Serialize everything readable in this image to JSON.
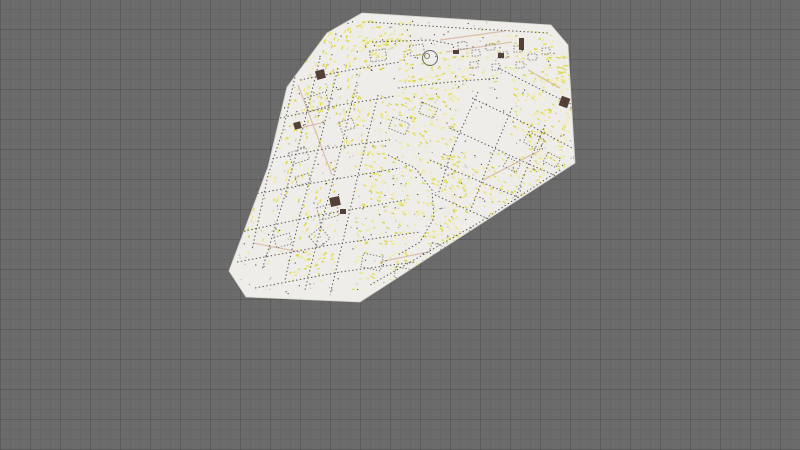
{
  "canvas": {
    "width": 800,
    "height": 450,
    "background": "#6b6b6b",
    "grid_minor_step": 10,
    "grid_major_step": 30
  },
  "map": {
    "fill": "#efedea",
    "edge_stroke": "#d6d3ce",
    "outline": [
      [
        362,
        13
      ],
      [
        551,
        25
      ],
      [
        568,
        45
      ],
      [
        575,
        163
      ],
      [
        360,
        302
      ],
      [
        246,
        297
      ],
      [
        229,
        271
      ],
      [
        268,
        167
      ],
      [
        287,
        87
      ],
      [
        327,
        33
      ]
    ],
    "colors": {
      "street": "#565656",
      "building": "#787672",
      "accent": "#d9bfae",
      "dark_mark": "#554038",
      "landmark": "#6b6b6b",
      "noise_dark": "#454545",
      "noise_light": "#c9c6c1",
      "noise_mid": "#8f8d89"
    },
    "label_colors": [
      "#e3df5e",
      "#eae781",
      "#f0eda6",
      "#d9d544",
      "#eeebc2"
    ],
    "streets": [
      [
        [
          300,
          55
        ],
        [
          283,
          130
        ],
        [
          268,
          175
        ],
        [
          252,
          250
        ]
      ],
      [
        [
          320,
          58
        ],
        [
          300,
          140
        ],
        [
          285,
          195
        ],
        [
          262,
          270
        ]
      ],
      [
        [
          338,
          68
        ],
        [
          318,
          150
        ],
        [
          300,
          215
        ],
        [
          285,
          280
        ]
      ],
      [
        [
          357,
          82
        ],
        [
          338,
          160
        ],
        [
          320,
          230
        ],
        [
          305,
          290
        ]
      ],
      [
        [
          378,
          95
        ],
        [
          358,
          175
        ],
        [
          342,
          245
        ],
        [
          330,
          295
        ]
      ],
      [
        [
          265,
          160
        ],
        [
          330,
          148
        ],
        [
          390,
          140
        ]
      ],
      [
        [
          250,
          195
        ],
        [
          330,
          180
        ],
        [
          400,
          168
        ]
      ],
      [
        [
          240,
          232
        ],
        [
          320,
          215
        ],
        [
          405,
          200
        ]
      ],
      [
        [
          237,
          262
        ],
        [
          330,
          245
        ],
        [
          420,
          232
        ]
      ],
      [
        [
          255,
          288
        ],
        [
          340,
          272
        ],
        [
          415,
          262
        ]
      ],
      [
        [
          280,
          118
        ],
        [
          340,
          105
        ],
        [
          395,
          96
        ]
      ],
      [
        [
          300,
          80
        ],
        [
          350,
          70
        ],
        [
          400,
          62
        ]
      ],
      [
        [
          430,
          160
        ],
        [
          500,
          190
        ],
        [
          550,
          210
        ]
      ],
      [
        [
          450,
          128
        ],
        [
          520,
          160
        ],
        [
          565,
          180
        ]
      ],
      [
        [
          472,
          98
        ],
        [
          535,
          128
        ],
        [
          572,
          148
        ]
      ],
      [
        [
          498,
          68
        ],
        [
          552,
          95
        ],
        [
          573,
          105
        ]
      ],
      [
        [
          435,
          195
        ],
        [
          495,
          222
        ],
        [
          530,
          238
        ]
      ],
      [
        [
          478,
          92
        ],
        [
          452,
          150
        ],
        [
          438,
          195
        ]
      ],
      [
        [
          512,
          108
        ],
        [
          488,
          165
        ],
        [
          470,
          212
        ]
      ],
      [
        [
          545,
          125
        ],
        [
          522,
          180
        ],
        [
          505,
          228
        ]
      ],
      [
        [
          368,
          22
        ],
        [
          460,
          28
        ],
        [
          548,
          33
        ]
      ],
      [
        [
          372,
          42
        ],
        [
          430,
          40
        ],
        [
          455,
          45
        ]
      ],
      [
        [
          398,
          88
        ],
        [
          450,
          82
        ],
        [
          500,
          78
        ]
      ],
      [
        [
          388,
          155
        ],
        [
          415,
          168
        ],
        [
          432,
          190
        ],
        [
          434,
          218
        ],
        [
          420,
          242
        ],
        [
          398,
          255
        ]
      ],
      [
        [
          560,
          170
        ],
        [
          480,
          222
        ],
        [
          400,
          268
        ],
        [
          370,
          285
        ]
      ]
    ],
    "accent_lines": [
      [
        [
          440,
          40
        ],
        [
          505,
          31
        ]
      ],
      [
        [
          446,
          52
        ],
        [
          512,
          42
        ]
      ],
      [
        [
          298,
          85
        ],
        [
          332,
          175
        ]
      ],
      [
        [
          253,
          243
        ],
        [
          300,
          252
        ]
      ],
      [
        [
          483,
          180
        ],
        [
          539,
          151
        ]
      ],
      [
        [
          380,
          262
        ],
        [
          428,
          252
        ]
      ],
      [
        [
          528,
          70
        ],
        [
          560,
          88
        ]
      ],
      [
        [
          300,
          128
        ],
        [
          325,
          122
        ]
      ]
    ],
    "buildings": [
      {
        "x": 306,
        "y": 95,
        "w": 22,
        "h": 14,
        "a": -18
      },
      {
        "x": 290,
        "y": 150,
        "w": 18,
        "h": 12,
        "a": -18
      },
      {
        "x": 318,
        "y": 205,
        "w": 20,
        "h": 13,
        "a": -15
      },
      {
        "x": 275,
        "y": 235,
        "w": 16,
        "h": 11,
        "a": -15
      },
      {
        "x": 340,
        "y": 120,
        "w": 14,
        "h": 10,
        "a": -18
      },
      {
        "x": 296,
        "y": 175,
        "w": 14,
        "h": 9,
        "a": -17
      },
      {
        "x": 370,
        "y": 50,
        "w": 16,
        "h": 11,
        "a": -8
      },
      {
        "x": 410,
        "y": 45,
        "w": 14,
        "h": 10,
        "a": -8
      },
      {
        "x": 458,
        "y": 42,
        "w": 9,
        "h": 7,
        "a": -5
      },
      {
        "x": 472,
        "y": 50,
        "w": 8,
        "h": 6,
        "a": -5
      },
      {
        "x": 486,
        "y": 44,
        "w": 9,
        "h": 6,
        "a": -5
      },
      {
        "x": 500,
        "y": 52,
        "w": 8,
        "h": 6,
        "a": -5
      },
      {
        "x": 514,
        "y": 46,
        "w": 8,
        "h": 6,
        "a": -3
      },
      {
        "x": 528,
        "y": 54,
        "w": 9,
        "h": 6,
        "a": -3
      },
      {
        "x": 542,
        "y": 48,
        "w": 8,
        "h": 6,
        "a": -3
      },
      {
        "x": 470,
        "y": 62,
        "w": 8,
        "h": 6,
        "a": -5
      },
      {
        "x": 492,
        "y": 64,
        "w": 8,
        "h": 6,
        "a": -5
      },
      {
        "x": 516,
        "y": 62,
        "w": 8,
        "h": 6,
        "a": -3
      },
      {
        "x": 525,
        "y": 135,
        "w": 18,
        "h": 12,
        "a": 28
      },
      {
        "x": 545,
        "y": 155,
        "w": 14,
        "h": 10,
        "a": 28
      },
      {
        "x": 505,
        "y": 160,
        "w": 14,
        "h": 10,
        "a": 28
      },
      {
        "x": 362,
        "y": 255,
        "w": 20,
        "h": 14,
        "a": 12
      },
      {
        "x": 395,
        "y": 268,
        "w": 16,
        "h": 11,
        "a": 12
      },
      {
        "x": 430,
        "y": 245,
        "w": 16,
        "h": 11,
        "a": 20
      },
      {
        "x": 468,
        "y": 230,
        "w": 16,
        "h": 11,
        "a": 22
      },
      {
        "x": 500,
        "y": 215,
        "w": 14,
        "h": 10,
        "a": 25
      },
      {
        "x": 390,
        "y": 120,
        "w": 18,
        "h": 12,
        "a": 22
      },
      {
        "x": 420,
        "y": 105,
        "w": 16,
        "h": 11,
        "a": 22
      },
      {
        "x": 312,
        "y": 230,
        "w": 15,
        "h": 15,
        "a": -40
      }
    ],
    "landmark_circle": {
      "cx": 430,
      "cy": 58,
      "r": 7.5,
      "inner_cx": 427,
      "inner_cy": 56,
      "inner_r": 2.5
    },
    "dark_marks": [
      {
        "x": 316,
        "y": 70,
        "w": 9,
        "h": 9,
        "a": -15
      },
      {
        "x": 294,
        "y": 122,
        "w": 7,
        "h": 7,
        "a": -15
      },
      {
        "x": 330,
        "y": 197,
        "w": 10,
        "h": 9,
        "a": -12
      },
      {
        "x": 560,
        "y": 97,
        "w": 9,
        "h": 10,
        "a": 20
      },
      {
        "x": 453,
        "y": 50,
        "w": 6,
        "h": 4,
        "a": 0
      },
      {
        "x": 498,
        "y": 53,
        "w": 6,
        "h": 5,
        "a": 0
      },
      {
        "x": 340,
        "y": 209,
        "w": 6,
        "h": 5,
        "a": 0
      },
      {
        "x": 519,
        "y": 38,
        "w": 5,
        "h": 12,
        "a": 0
      }
    ],
    "label_clusters": [
      {
        "cx": 330,
        "cy": 75,
        "w": 60,
        "h": 90,
        "a": -70,
        "n": 130
      },
      {
        "cx": 383,
        "cy": 35,
        "w": 55,
        "h": 30,
        "a": -15,
        "n": 80
      },
      {
        "cx": 432,
        "cy": 75,
        "w": 70,
        "h": 50,
        "a": -10,
        "n": 110
      },
      {
        "cx": 512,
        "cy": 55,
        "w": 95,
        "h": 55,
        "a": -5,
        "n": 90
      },
      {
        "cx": 540,
        "cy": 105,
        "w": 60,
        "h": 60,
        "a": 30,
        "n": 120
      },
      {
        "cx": 420,
        "cy": 120,
        "w": 80,
        "h": 55,
        "a": 25,
        "n": 130
      },
      {
        "cx": 355,
        "cy": 130,
        "w": 40,
        "h": 60,
        "a": -70,
        "n": 60
      },
      {
        "cx": 410,
        "cy": 195,
        "w": 115,
        "h": 85,
        "a": 20,
        "n": 260
      },
      {
        "cx": 495,
        "cy": 185,
        "w": 95,
        "h": 70,
        "a": 30,
        "n": 150
      },
      {
        "cx": 310,
        "cy": 200,
        "w": 50,
        "h": 80,
        "a": -70,
        "n": 70
      },
      {
        "cx": 260,
        "cy": 220,
        "w": 40,
        "h": 90,
        "a": -75,
        "n": 50
      },
      {
        "cx": 310,
        "cy": 265,
        "w": 45,
        "h": 35,
        "a": -20,
        "n": 45
      },
      {
        "cx": 385,
        "cy": 265,
        "w": 70,
        "h": 50,
        "a": 15,
        "n": 60
      },
      {
        "cx": 455,
        "cy": 250,
        "w": 60,
        "h": 40,
        "a": 25,
        "n": 55
      },
      {
        "cx": 545,
        "cy": 150,
        "w": 40,
        "h": 40,
        "a": 30,
        "n": 70
      },
      {
        "cx": 300,
        "cy": 120,
        "w": 45,
        "h": 60,
        "a": -65,
        "n": 60
      },
      {
        "cx": 365,
        "cy": 55,
        "w": 40,
        "h": 30,
        "a": -20,
        "n": 40
      },
      {
        "cx": 555,
        "cy": 70,
        "w": 30,
        "h": 40,
        "a": 10,
        "n": 50
      }
    ],
    "noise": {
      "bbox": [
        228,
        12,
        578,
        295
      ],
      "dark_count": 260,
      "light_count": 160,
      "mid_count": 80
    }
  }
}
